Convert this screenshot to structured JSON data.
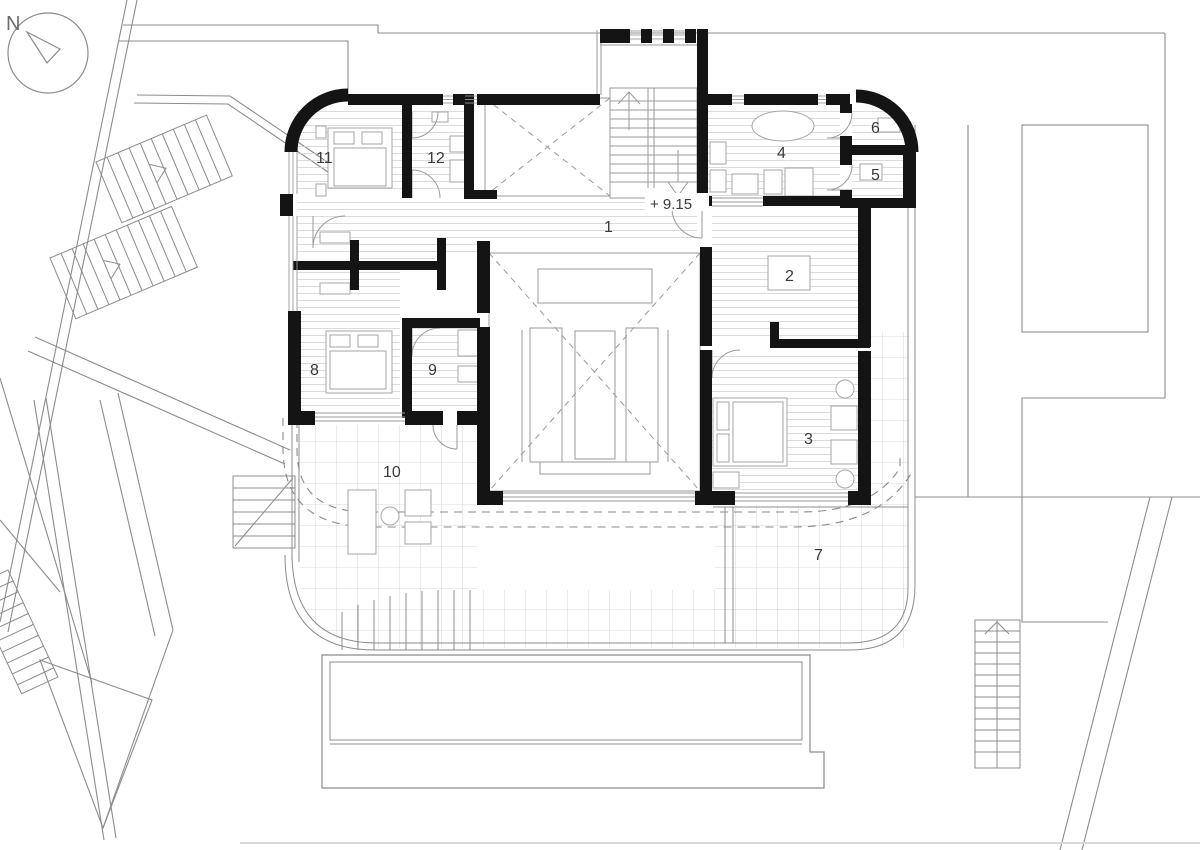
{
  "drawing": {
    "type": "architectural floor plan",
    "north_indicator": {
      "label": "N"
    },
    "elevation_marker": {
      "value": "+ 9.15"
    },
    "room_labels": {
      "r1": "1",
      "r2": "2",
      "r3": "3",
      "r4": "4",
      "r5": "5",
      "r6": "6",
      "r7": "7",
      "r8": "8",
      "r9": "9",
      "r10": "10",
      "r11": "11",
      "r12": "12"
    },
    "palette": {
      "walls": "#141414",
      "context_lines": "#8c8c8c",
      "thin_lines": "#9a9a9a",
      "floor_hatch": "#d2d2d2",
      "tile_grid": "#cccccc",
      "background": "#ffffff",
      "label_color": "#3a3a3a"
    }
  }
}
